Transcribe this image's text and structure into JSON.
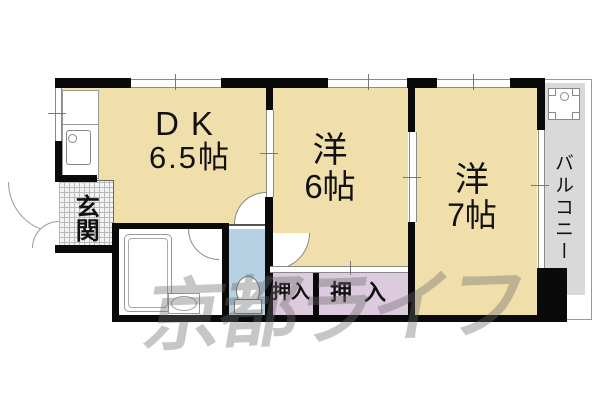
{
  "floorplan": {
    "rooms": {
      "dk": {
        "name": "DK",
        "size": "6.5帖"
      },
      "west6": {
        "name": "洋",
        "size": "6帖"
      },
      "west7": {
        "name": "洋",
        "size": "7帖"
      },
      "genkan": {
        "label": "玄関"
      },
      "balcony": {
        "label": "バルコニー"
      },
      "closet_left": {
        "label": "押入"
      },
      "closet_right": {
        "label": "押入"
      }
    },
    "watermark": {
      "text": "京都ライフ"
    },
    "colors": {
      "floor": "#f0dfaa",
      "toilet_room": "#b5d1e3",
      "closet": "#dccade",
      "balcony": "#d9d9d9",
      "wall": "#0a0a0a",
      "watermark": "rgba(105,105,105,0.38)"
    }
  }
}
